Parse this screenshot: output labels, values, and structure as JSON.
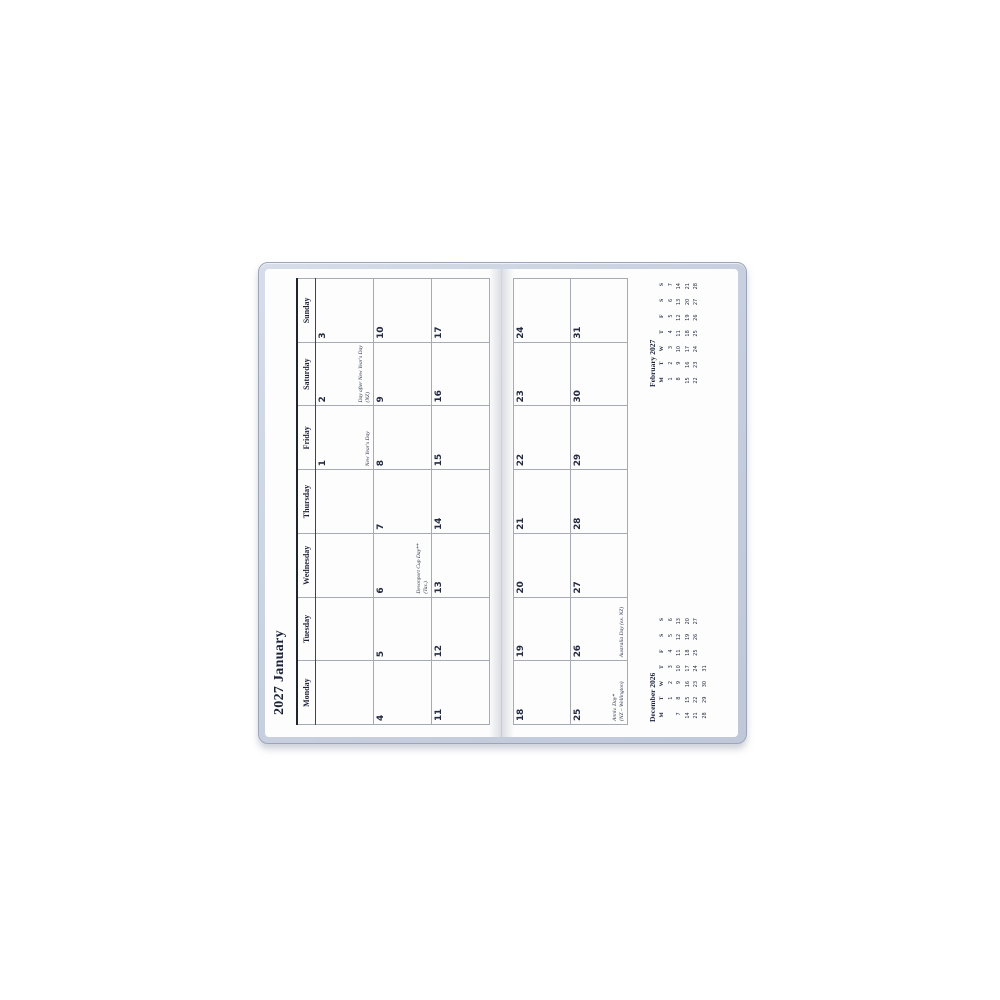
{
  "planner": {
    "title": "2027 January",
    "weekday_headers": [
      "Monday",
      "Tuesday",
      "Wednesday",
      "Thursday",
      "Friday",
      "Saturday",
      "Sunday"
    ],
    "left_weeks": [
      {
        "days": [
          {
            "num": ""
          },
          {
            "num": ""
          },
          {
            "num": ""
          },
          {
            "num": ""
          },
          {
            "num": "1",
            "note_lines": [
              "New Year's Day"
            ]
          },
          {
            "num": "2",
            "note_lines": [
              "Day after New Year's Day",
              "(NZ)"
            ]
          },
          {
            "num": "3"
          }
        ]
      },
      {
        "days": [
          {
            "num": "4"
          },
          {
            "num": "5"
          },
          {
            "num": "6",
            "note_lines": [
              "Devonport Cup Day**",
              "(Tas.)"
            ]
          },
          {
            "num": "7"
          },
          {
            "num": "8"
          },
          {
            "num": "9"
          },
          {
            "num": "10"
          }
        ]
      },
      {
        "days": [
          {
            "num": "11"
          },
          {
            "num": "12"
          },
          {
            "num": "13"
          },
          {
            "num": "14"
          },
          {
            "num": "15"
          },
          {
            "num": "16"
          },
          {
            "num": "17"
          }
        ]
      }
    ],
    "right_weeks": [
      {
        "days": [
          {
            "num": "18"
          },
          {
            "num": "19"
          },
          {
            "num": "20"
          },
          {
            "num": "21"
          },
          {
            "num": "22"
          },
          {
            "num": "23"
          },
          {
            "num": "24"
          }
        ]
      },
      {
        "days": [
          {
            "num": "25",
            "note_lines": [
              "Anniv. Day*",
              "(NZ – Wellington)"
            ]
          },
          {
            "num": "26",
            "note_lines": [
              "Australia Day (ex. NZ)"
            ]
          },
          {
            "num": "27"
          },
          {
            "num": "28"
          },
          {
            "num": "29"
          },
          {
            "num": "30"
          },
          {
            "num": "31"
          }
        ]
      }
    ],
    "mini_calendars": [
      {
        "title": "December 2026",
        "dow": [
          "M",
          "T",
          "W",
          "T",
          "F",
          "S",
          "S"
        ],
        "weeks": [
          [
            "",
            "1",
            "2",
            "3",
            "4",
            "5",
            "6"
          ],
          [
            "7",
            "8",
            "9",
            "10",
            "11",
            "12",
            "13"
          ],
          [
            "14",
            "15",
            "16",
            "17",
            "18",
            "19",
            "20"
          ],
          [
            "21",
            "22",
            "23",
            "24",
            "25",
            "26",
            "27"
          ],
          [
            "28",
            "29",
            "30",
            "31",
            "",
            "",
            ""
          ]
        ]
      },
      {
        "title": "February 2027",
        "dow": [
          "M",
          "T",
          "W",
          "T",
          "F",
          "S",
          "S"
        ],
        "weeks": [
          [
            "1",
            "2",
            "3",
            "4",
            "5",
            "6",
            "7"
          ],
          [
            "8",
            "9",
            "10",
            "11",
            "12",
            "13",
            "14"
          ],
          [
            "15",
            "16",
            "17",
            "18",
            "19",
            "20",
            "21"
          ],
          [
            "22",
            "23",
            "24",
            "25",
            "26",
            "27",
            "28"
          ]
        ]
      }
    ]
  },
  "colors": {
    "ink": "#242b40",
    "title_ink": "#1c2337",
    "grid_outer": "#2f3542",
    "grid_inner": "#a6aab3",
    "cover": "#c9d1e0",
    "cover_border": "#9ba6bb",
    "page": "#fdfdfe"
  }
}
